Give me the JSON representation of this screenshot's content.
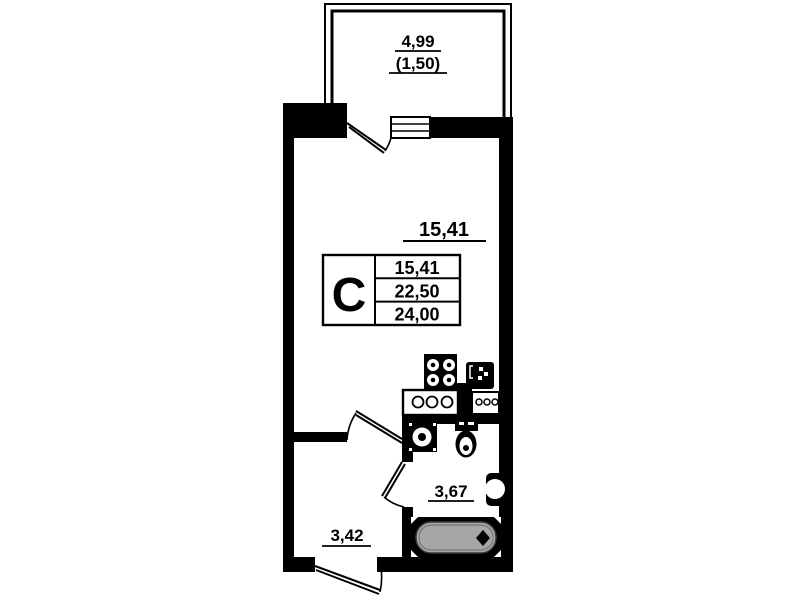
{
  "plan": {
    "type": "studio-apartment-floor-plan",
    "balcony": {
      "area": "4,99",
      "area_reduced": "(1,50)"
    },
    "room": {
      "area": "15,41"
    },
    "bathroom": {
      "area": "3,67"
    },
    "hallway": {
      "area": "3,42"
    },
    "legend": {
      "unit_type": "С",
      "living_area": "15,41",
      "total_area": "22,50",
      "total_area_with_balcony": "24,00"
    },
    "fixtures": [
      "stove-icon",
      "kitchen-sink-icon",
      "kitchen-counter",
      "washing-machine-icon",
      "toilet-icon",
      "wash-basin-icon",
      "bathtub-icon"
    ]
  },
  "colors": {
    "wall": "#000000",
    "background": "#ffffff",
    "bathtub_fill": "#a6a6a6"
  }
}
